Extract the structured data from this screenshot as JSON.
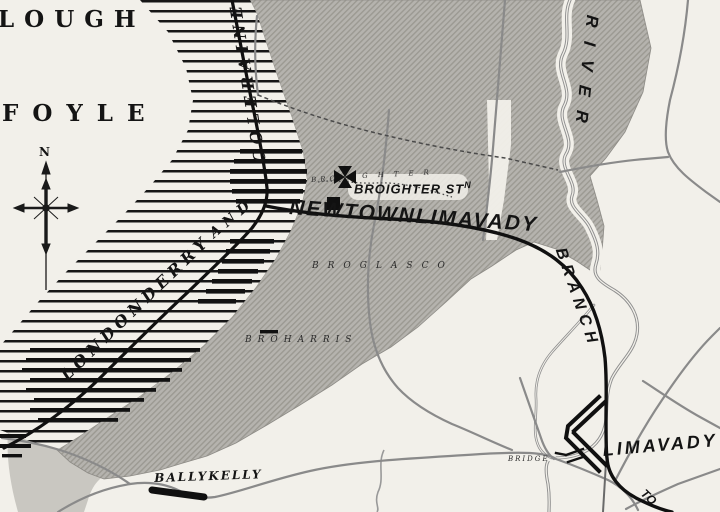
{
  "map": {
    "water_labels": {
      "lough": "LOUGH",
      "foyle": "FOYLE"
    },
    "railway_labels": {
      "londonderry": "LONDONDERRY",
      "and": "AND",
      "coleraine": "COLERAINE",
      "newtownlimavady": "NEWTOWNLIMAVADY",
      "branch": "BRANCH",
      "to": "TO"
    },
    "river_label": "RIVER",
    "stations": {
      "broighter_main": "BROIGHTER ST",
      "broighter_sup": "N",
      "limavady": "LIMAVADY",
      "ballykelly": "BALLYKELLY"
    },
    "townlands": {
      "broighter_left": "BRO",
      "broighter_right": "GHTER",
      "broglasco": "BROGLASCO",
      "broharris": "BROHARRIS"
    },
    "bridge_label": "BRIDGE",
    "compass_north": "N",
    "colors": {
      "paper": "#f2f0ea",
      "land": "#b5b3ae",
      "land_stripe": "#9b9992",
      "hatch_line": "#161616",
      "rail": "#101010",
      "road": "#8a8a8a",
      "river": "#8f8f8f"
    }
  }
}
